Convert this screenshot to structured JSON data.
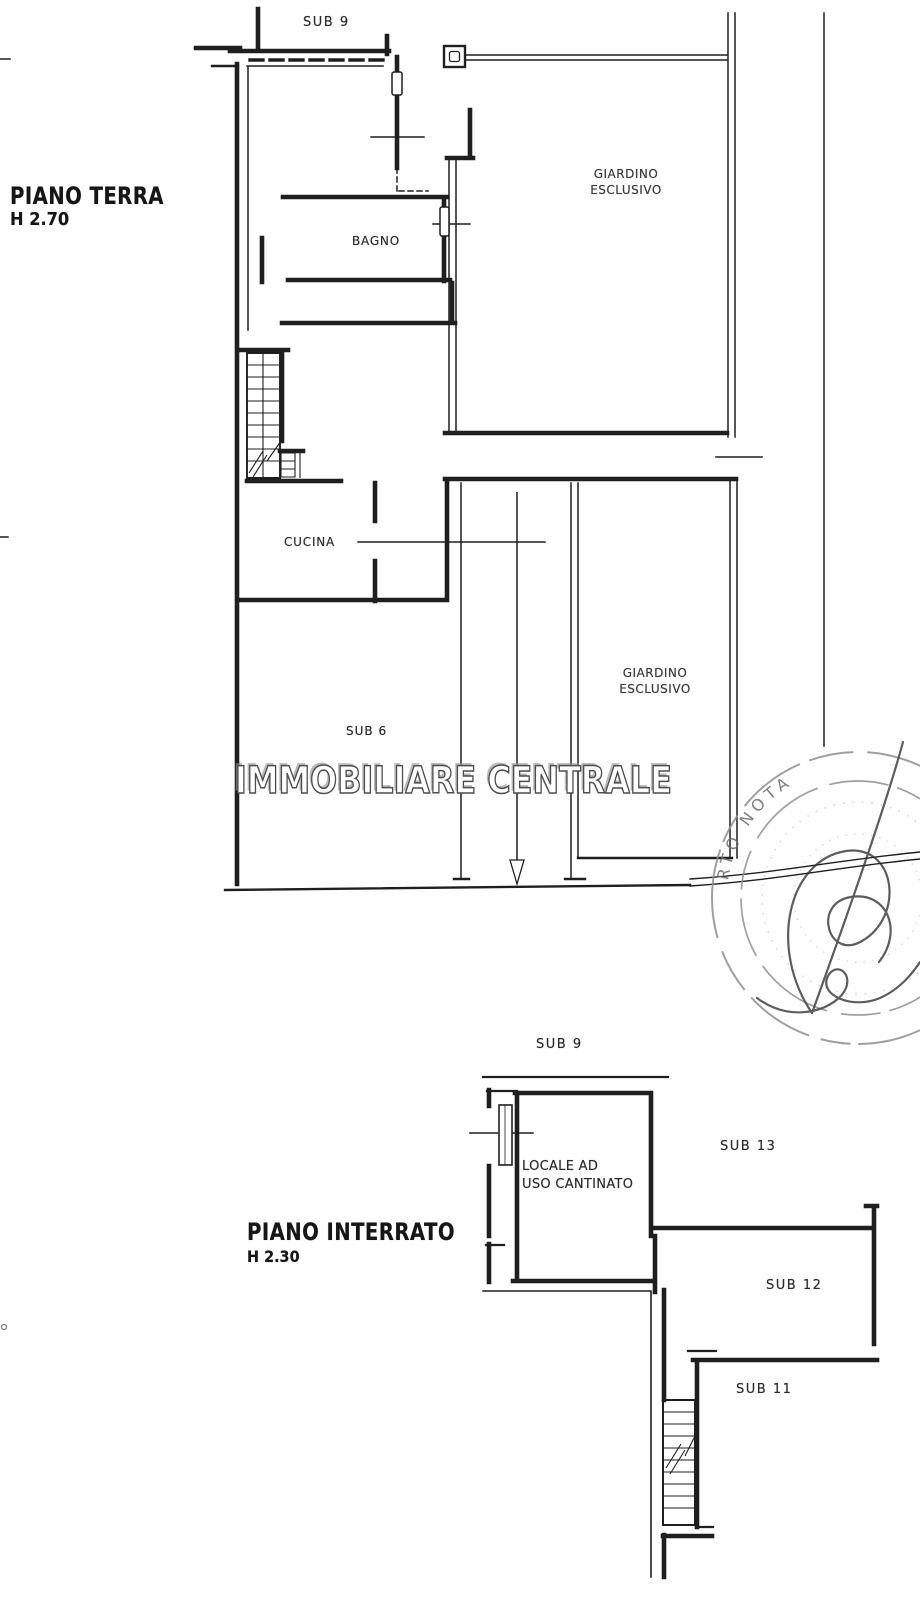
{
  "ground_floor": {
    "title": "PIANO TERRA",
    "height": "H 2.70",
    "rooms": {
      "sub9": "SUB 9",
      "bagno": "BAGNO",
      "cucina": "CUCINA",
      "sub6": "SUB 6",
      "garden_top": {
        "line1": "GIARDINO",
        "line2": "ESCLUSIVO"
      },
      "garden_bottom": {
        "line1": "GIARDINO",
        "line2": "ESCLUSIVO"
      }
    }
  },
  "basement_floor": {
    "title": "PIANO INTERRATO",
    "height": "H 2.30",
    "rooms": {
      "sub9": "SUB 9",
      "cellar": {
        "line1": "LOCALE AD",
        "line2": "USO CANTINATO"
      },
      "sub13": "SUB 13",
      "sub12": "SUB 12",
      "sub11": "SUB 11"
    }
  },
  "watermark": {
    "text": "IMMOBILIARE CENTRALE"
  },
  "stamp": {
    "visible_arc_text": "RTO NOTA"
  },
  "colors": {
    "background": "#ffffff",
    "ink": "#1f1f1f",
    "label": "#2b2b2b",
    "watermark_outline": "#4d4d4d",
    "stamp_gray": "#8f8f8f"
  }
}
